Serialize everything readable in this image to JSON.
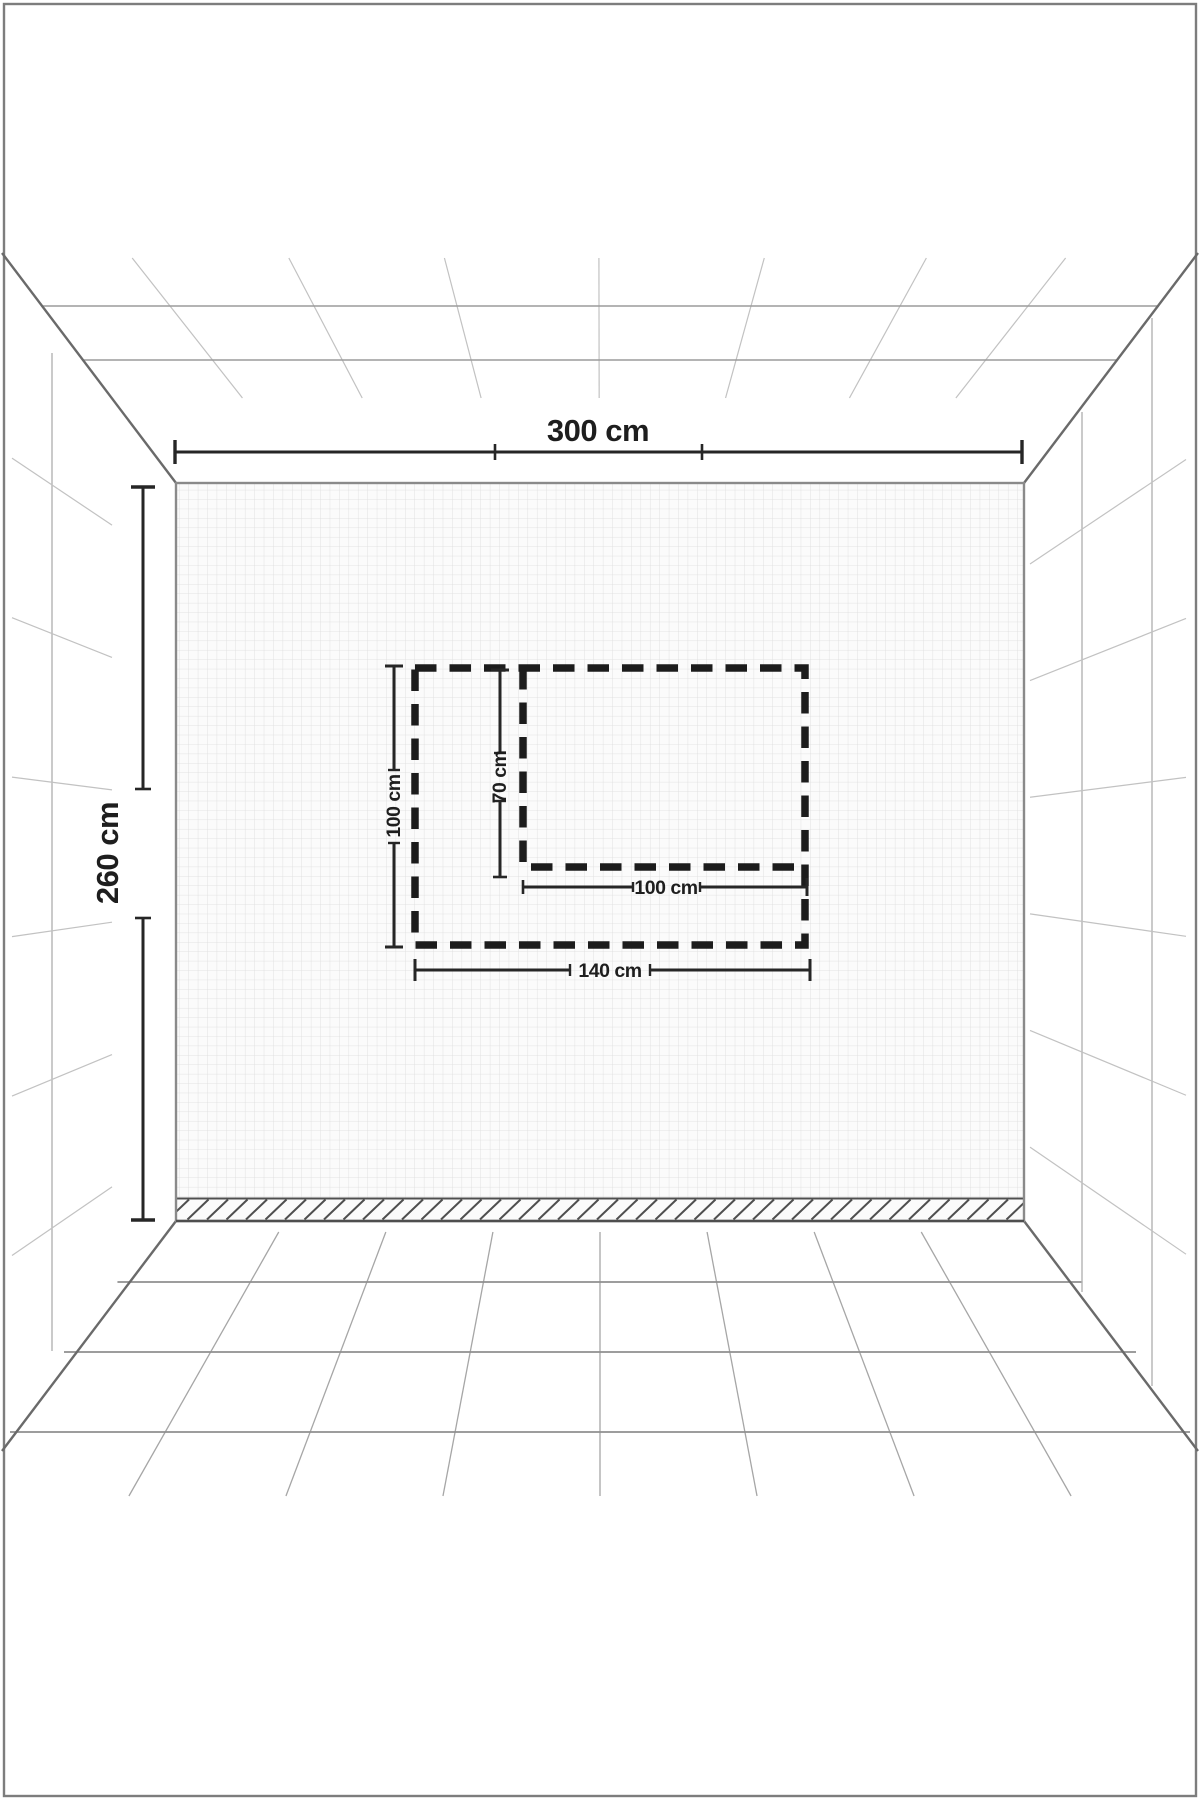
{
  "diagram": {
    "description": "perspective-room-wall-dimension-diagram",
    "room": {
      "wall_width_label": "300 cm",
      "wall_height_label": "260 cm"
    },
    "marked_area": {
      "outer_height_label": "100 cm",
      "inner_height_label": "70 cm",
      "inner_width_label": "100 cm",
      "outer_width_label": "140 cm"
    },
    "colors": {
      "dash_outline": "#1c1c1c",
      "dimension_line": "#262626",
      "wall_grid": "#dcdcdc",
      "wall_fill": "#fbfbfb",
      "perspective_light": "#c2c2c2",
      "perspective_mid": "#9b9b9b",
      "corner_edge": "#6a6a6a",
      "frame": "#7d7d7d",
      "hatch": "#4f4f4f"
    }
  }
}
